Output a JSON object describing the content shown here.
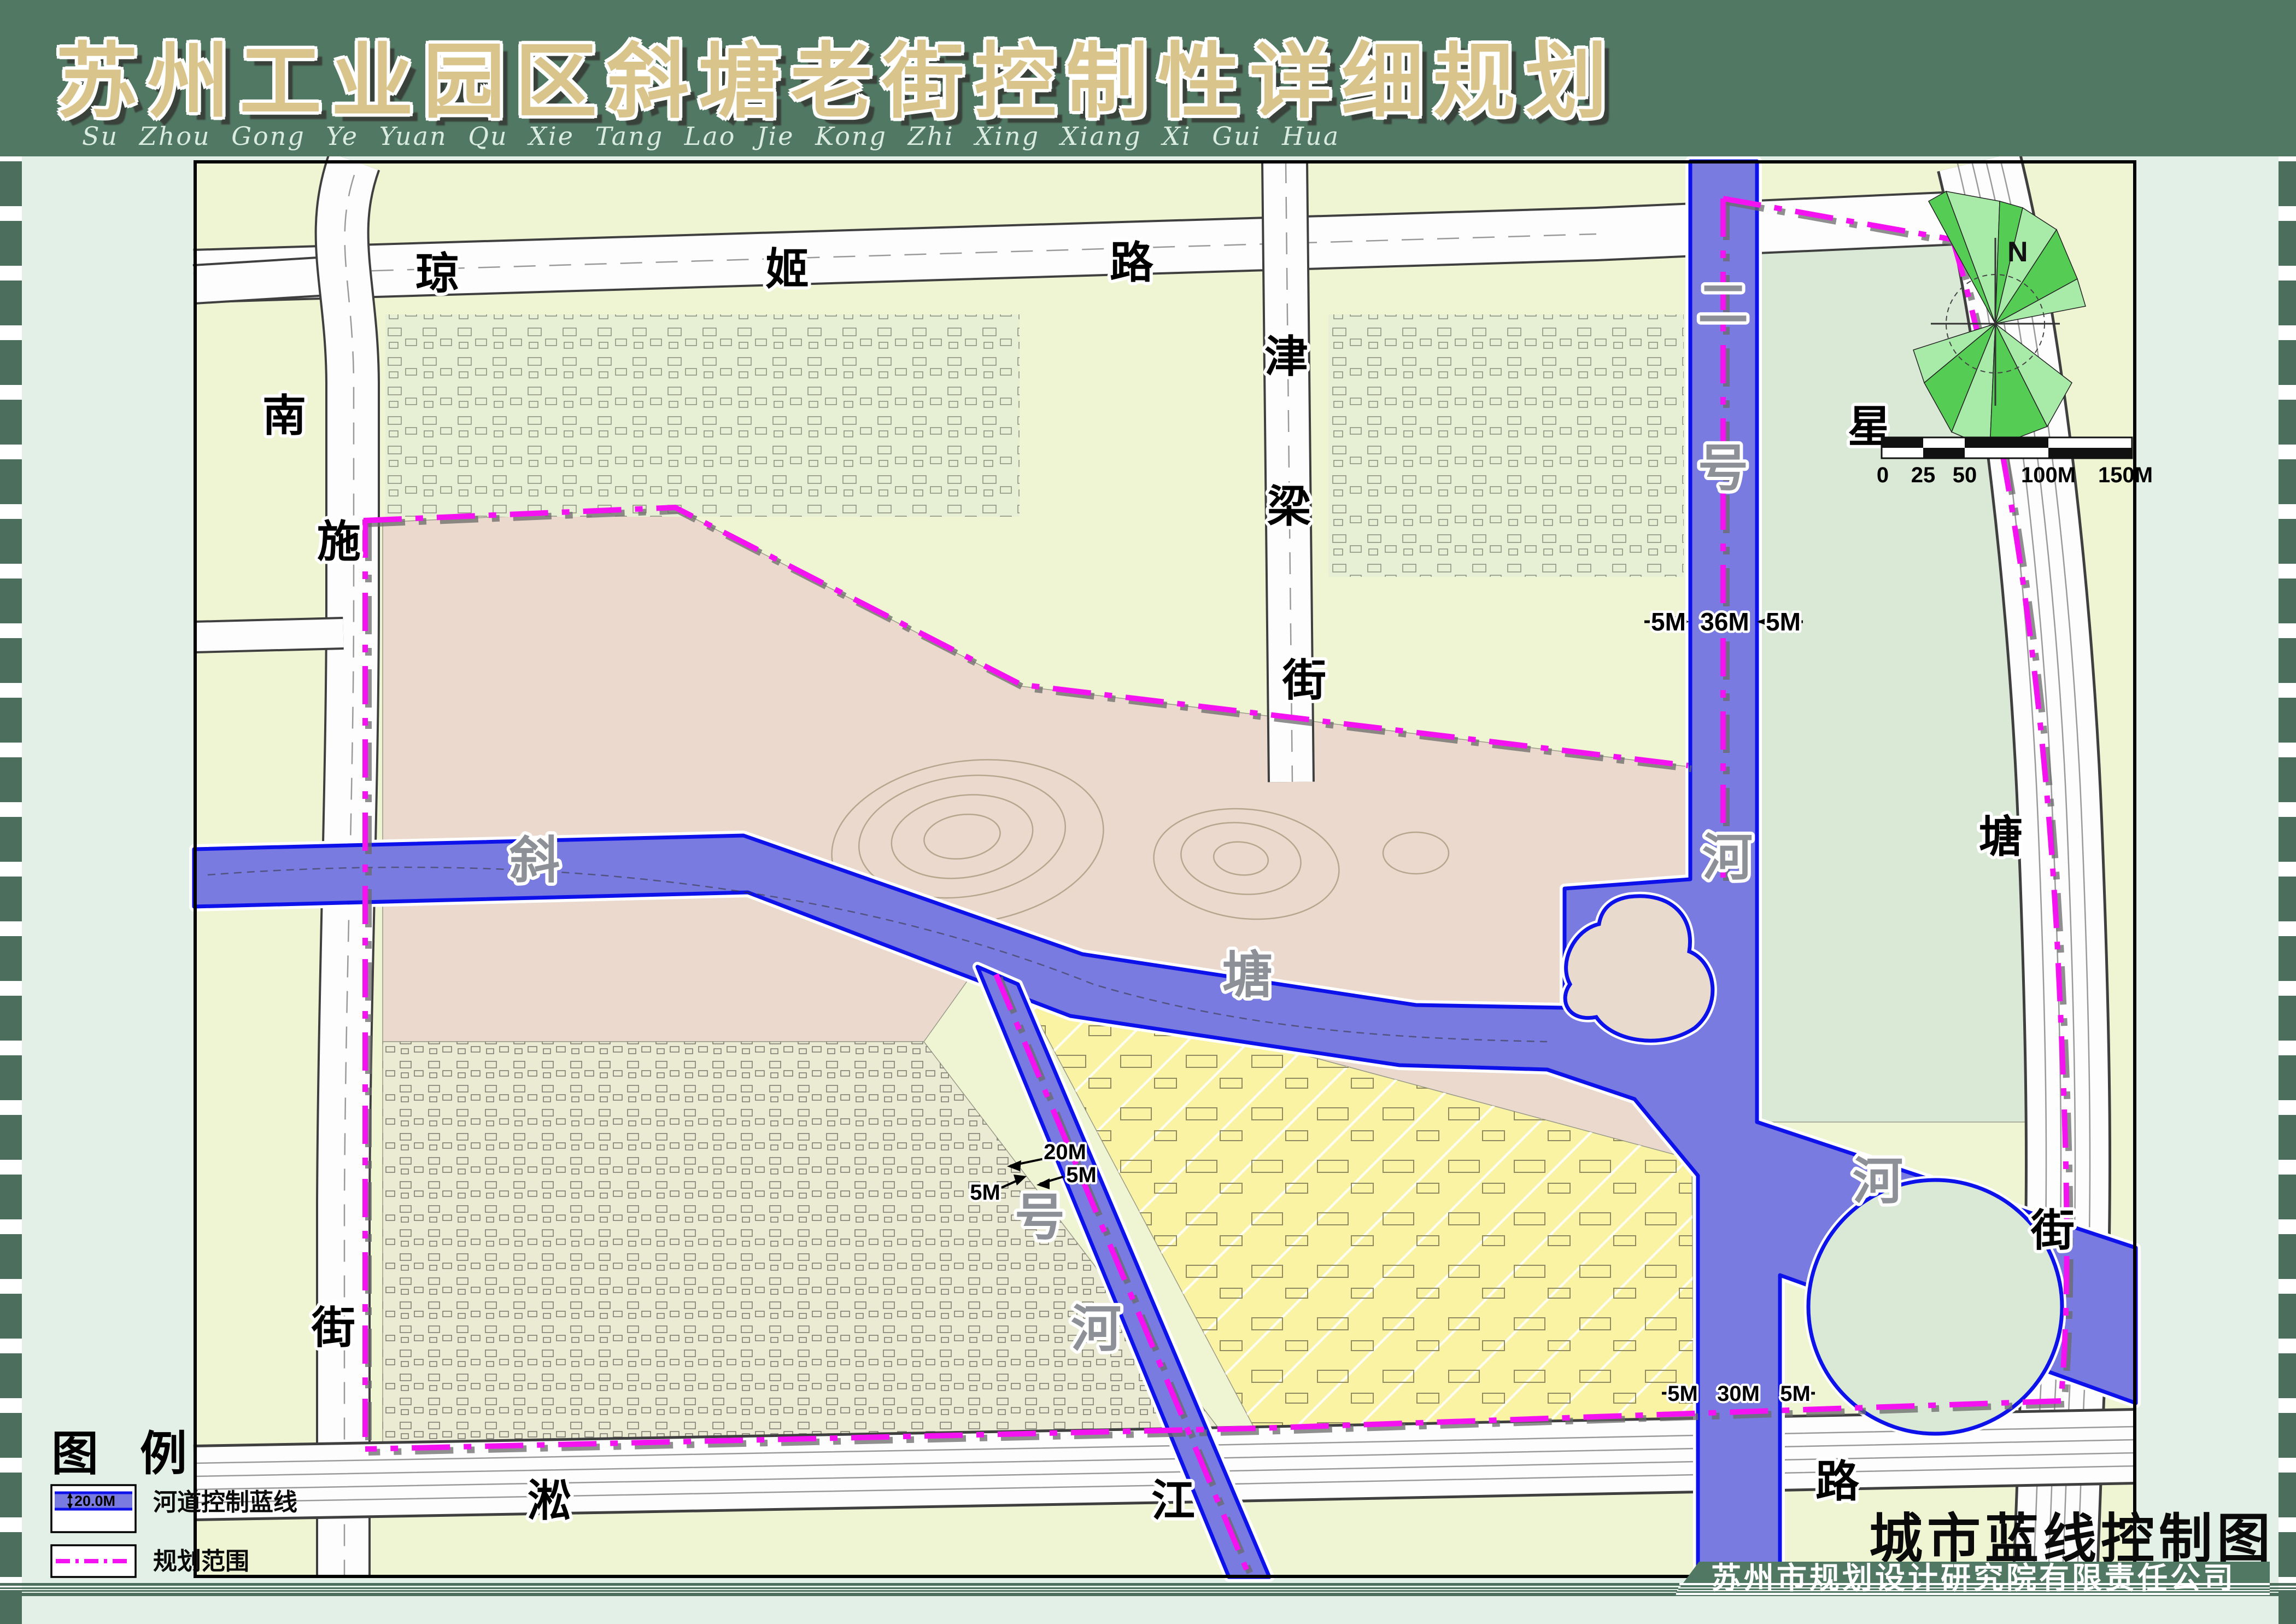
{
  "header": {
    "title": "苏州工业园区斜塘老街控制性详细规划",
    "subtitle": "Su Zhou    Gong Ye Yuan Qu    Xie Tang Lao Jie    Kong Zhi Xing    Xiang Xi Gui Hua"
  },
  "map_title": "城市蓝线控制图",
  "company": "苏州市规划设计研究院有限责任公司",
  "legend": {
    "title": "图 例",
    "item1": {
      "label": "河道控制蓝线",
      "dim": "20.0M"
    },
    "item2": {
      "label": "规划范围"
    }
  },
  "north": {
    "label": "N"
  },
  "scalebar": {
    "t0": "0",
    "t25": "25",
    "t50": "50",
    "t100": "100M",
    "t150": "150M"
  },
  "streets": {
    "qiongji": [
      "琼",
      "姬",
      "路"
    ],
    "nanshi": [
      "南",
      "施",
      "街"
    ],
    "jinliang": [
      "津",
      "梁",
      "街"
    ],
    "xingtang": [
      "星",
      "塘",
      "街"
    ],
    "songjiang": [
      "淞",
      "江",
      "路"
    ]
  },
  "rivers": {
    "xietang": [
      "斜",
      "塘",
      "河"
    ],
    "erhao": [
      "二",
      "号",
      "河"
    ],
    "yihao": [
      "号",
      "河"
    ]
  },
  "dims": {
    "top": [
      "5M",
      "36M",
      "5M"
    ],
    "one_a": "20M",
    "one_b": "5M",
    "one_c": "5M",
    "south": [
      "5M",
      "30M",
      "5M"
    ]
  },
  "colors": {
    "header_green": "#517862",
    "checker_green": "#4c6e5c",
    "title_tan": "#d9c58c",
    "map_base": "#eff5d3",
    "river_fill": "#797be0",
    "blue_line": "#0d12ea",
    "boundary_magenta": "#f512f0",
    "plan_pink": "#ead9cc",
    "plan_yellow": "#f9f3a3",
    "park_sage": "#d9e9d6",
    "oldtown": "#ebebd3"
  }
}
